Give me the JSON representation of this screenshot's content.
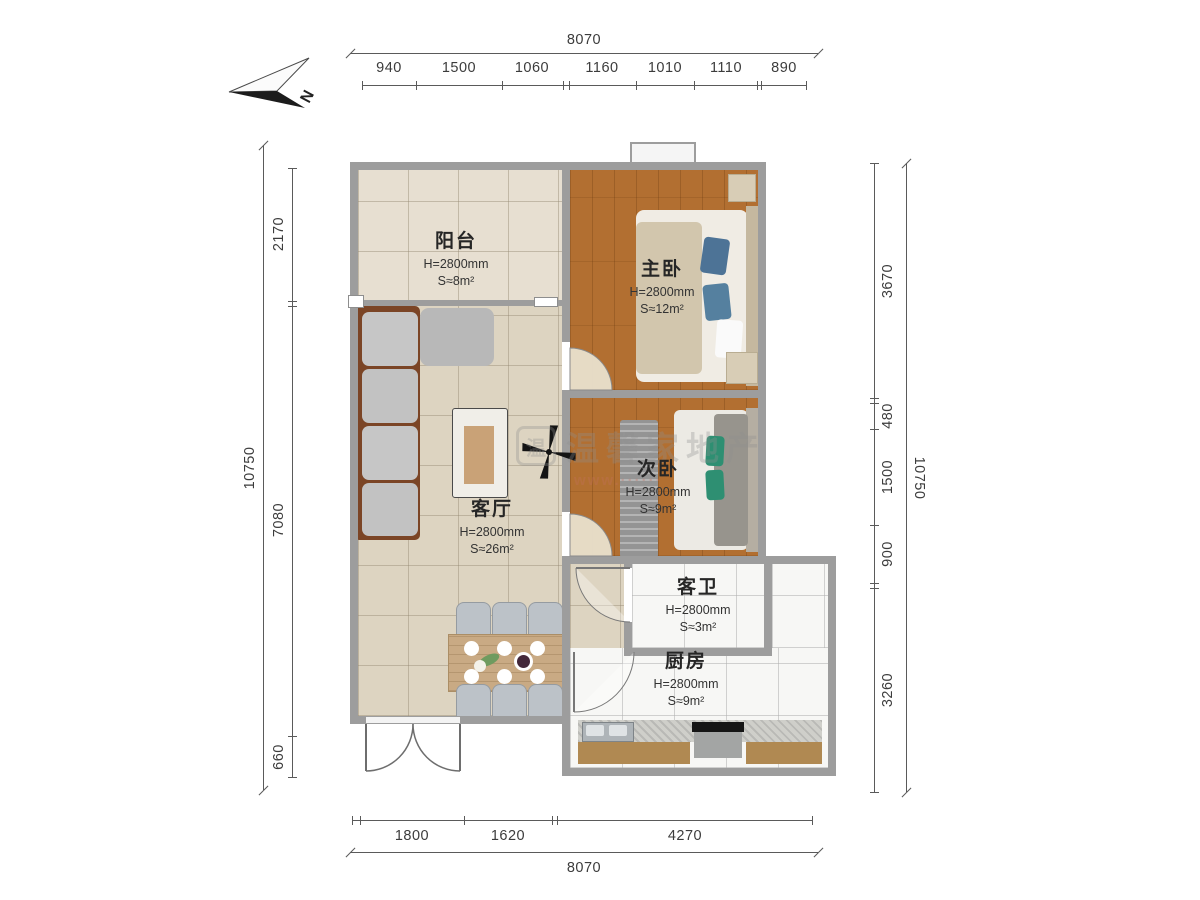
{
  "compass": {
    "label": "N"
  },
  "watermark": {
    "logo": "温",
    "text": "温馨家地产",
    "url": "www.······"
  },
  "dims": {
    "top": {
      "total": "8070",
      "segments": [
        "940",
        "1500",
        "1060",
        "1160",
        "1010",
        "1110",
        "890"
      ]
    },
    "bottom": {
      "total": "8070",
      "segments": [
        "1800",
        "1620",
        "4270"
      ]
    },
    "left": {
      "total": "10750",
      "segments": [
        "2170",
        "7080",
        "660"
      ]
    },
    "right": {
      "total": "10750",
      "segments": [
        "3670",
        "480",
        "1500",
        "900",
        "3260"
      ]
    }
  },
  "rooms": {
    "balcony": {
      "name": "阳台",
      "height": "H=2800mm",
      "area": "S≈8m²"
    },
    "master": {
      "name": "主卧",
      "height": "H=2800mm",
      "area": "S≈12m²"
    },
    "second": {
      "name": "次卧",
      "height": "H=2800mm",
      "area": "S≈9m²"
    },
    "living": {
      "name": "客厅",
      "height": "H=2800mm",
      "area": "S≈26m²"
    },
    "bath": {
      "name": "客卫",
      "height": "H=2800mm",
      "area": "S≈3m²"
    },
    "kitchen": {
      "name": "厨房",
      "height": "H=2800mm",
      "area": "S≈9m²"
    }
  },
  "colors": {
    "wall": "#9d9d9d",
    "wood": "#b26f31",
    "tileLine": "rgba(150,138,115,0.45)",
    "marbleLine": "rgba(176,176,176,0.55)",
    "accentBlue": "#4d7396",
    "accentGreen": "#2e8f72",
    "frameBrown": "#7b4526",
    "counterBrown": "#b08952",
    "tableWood": "#c9aa84"
  }
}
